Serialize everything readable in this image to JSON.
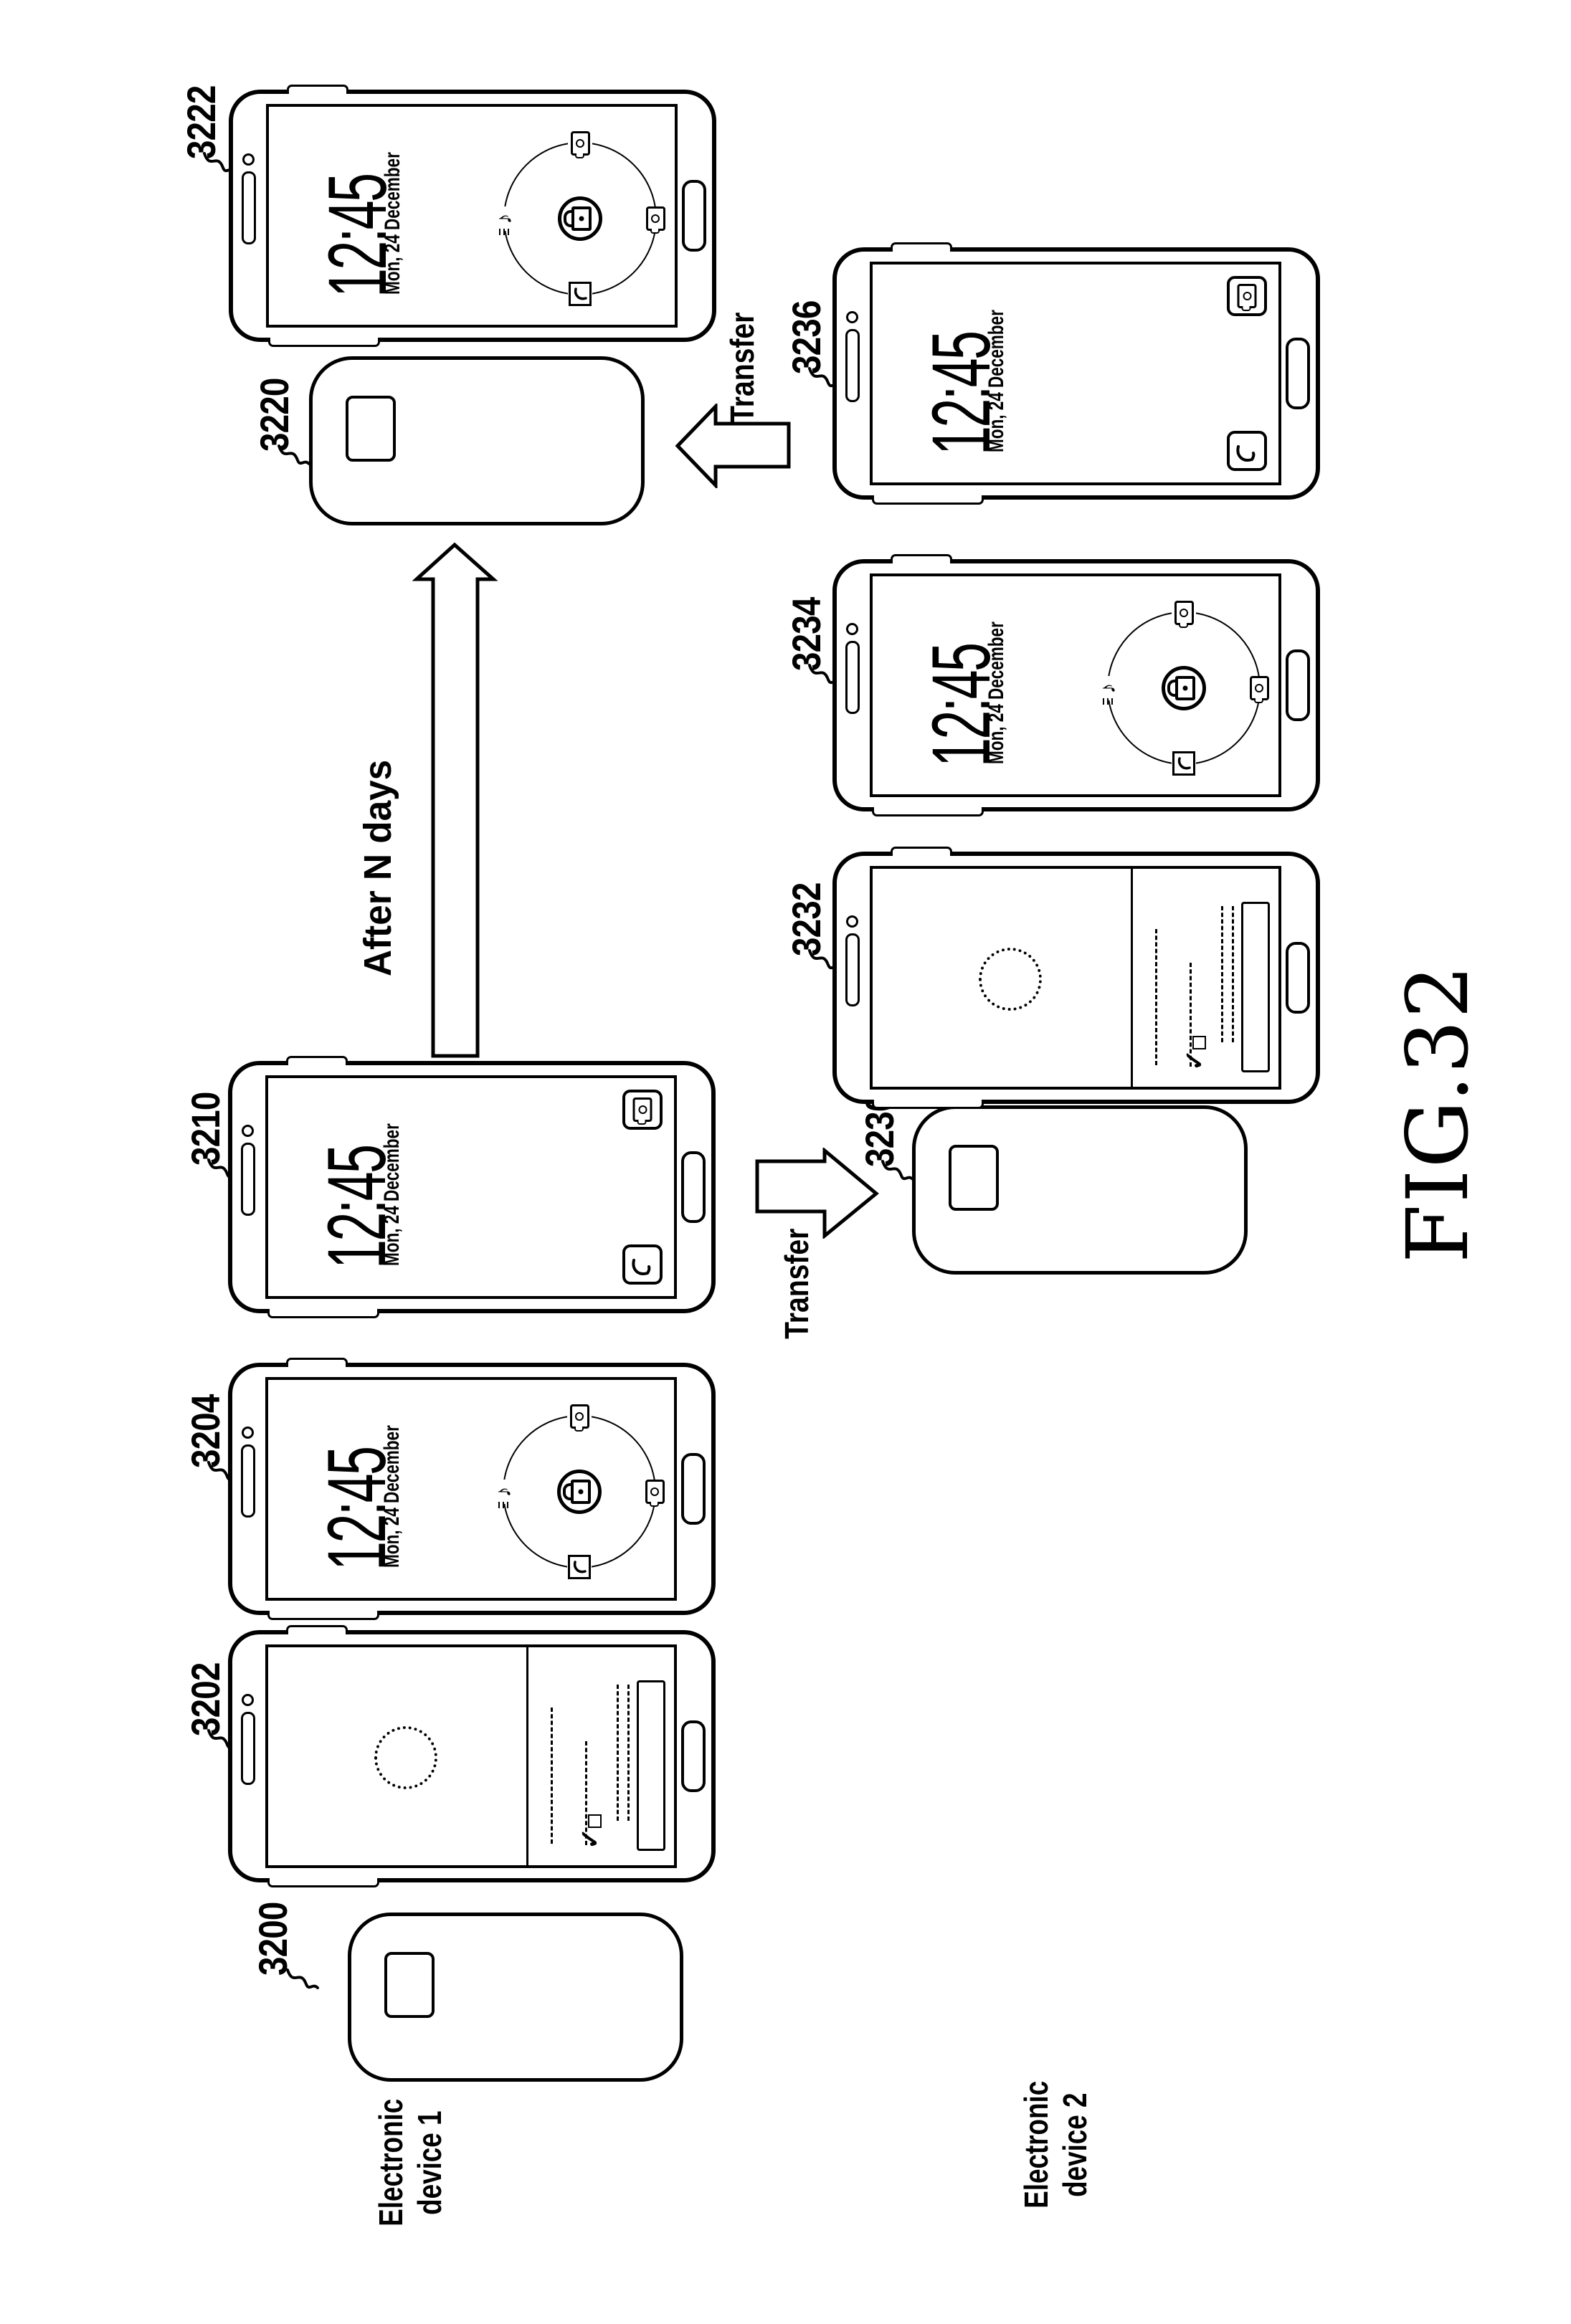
{
  "figure": {
    "title": "FIG.32"
  },
  "lockscreen": {
    "time": "12:45",
    "date": "Mon, 24 December"
  },
  "labels": {
    "d3200": "3200",
    "d3202": "3202",
    "d3204": "3204",
    "d3210": "3210",
    "d3220": "3220",
    "d3222": "3222",
    "d3230": "3230",
    "d3232": "3232",
    "d3234": "3234",
    "d3236": "3236"
  },
  "annotations": {
    "after_n_days": "After N days",
    "transfer_down": "Transfer",
    "transfer_up": "Transfer"
  },
  "device_groups": {
    "device1": {
      "line1": "Electronic",
      "line2": "device 1"
    },
    "device2": {
      "line1": "Electronic",
      "line2": "device 2"
    }
  },
  "glyphs": {
    "music_note": "♪",
    "checkmark": "✓"
  },
  "colors": {
    "ink": "#000000",
    "paper": "#ffffff"
  }
}
